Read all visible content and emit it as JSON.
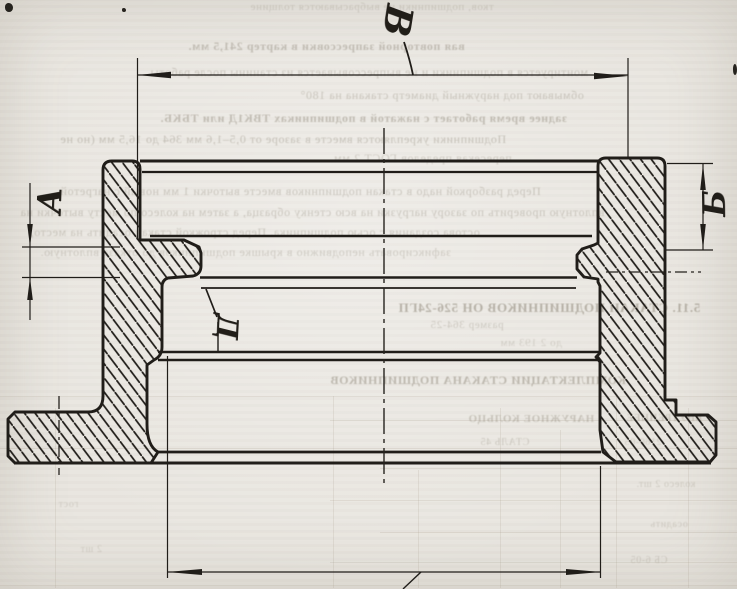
{
  "drawing": {
    "kind": "scanned engineering cross-section drawing",
    "ink_color": "#201d19",
    "paper_color": "#e9e6e0",
    "section_labels": {
      "top_dimension": "В",
      "left_dimension": "А",
      "right_dimension": "Б",
      "bore_callout": "Д"
    }
  },
  "bleedthrough": {
    "note": "mirrored show-through text from reverse page side",
    "color": "#837b6c",
    "heading1": "5.11. СТАКАН ПОДШИПНИКОВ ОН 526-24ГП",
    "heading2": "КОМПЛЕКТАЦИИ СТАКАНА ПОДШИПНИКОВ",
    "lines": [
      {
        "t": "тков, подшипники не выбрасываются толщине",
        "x": 250,
        "y": 2,
        "s": 11,
        "b": 0,
        "o": 0.26
      },
      {
        "t": "вая повторной запрессовки в картер 241,5 мм.",
        "x": 188,
        "y": 40,
        "s": 12,
        "b": 1,
        "o": 0.38
      },
      {
        "t": "монтируется в подшипники и не выпрессовывается из станины после работы",
        "x": 150,
        "y": 66,
        "s": 12,
        "b": 0,
        "o": 0.32
      },
      {
        "t": "обмывают под наружный диаметр стакана на 180°",
        "x": 300,
        "y": 89,
        "s": 12,
        "b": 0,
        "o": 0.33
      },
      {
        "t": "заднее время работает с нажатой в подшипниках ТВК1Д или ТБКБ.",
        "x": 160,
        "y": 112,
        "s": 12,
        "b": 1,
        "o": 0.4
      },
      {
        "t": "Подшипники укрепляются вместе в зазоре от 0,5–1,6 мм 364 до 16,5 мм (но не",
        "x": 60,
        "y": 133,
        "s": 12,
        "b": 0,
        "o": 0.36
      },
      {
        "t": "пересекая пределов ГОСТ 2 мм.",
        "x": 330,
        "y": 152,
        "s": 12,
        "b": 0,
        "o": 0.3
      },
      {
        "t": "Перед разборкой надо в стакан подшипников вместе выточки 1 мм новый с нагретой",
        "x": 60,
        "y": 185,
        "s": 12,
        "b": 0,
        "o": 0.33
      },
      {
        "t": "вплотную проверить по зазору нагрузки на всю стенку образца, а затем на колесо по месту выточки на",
        "x": 20,
        "y": 206,
        "s": 12,
        "b": 0,
        "o": 0.33
      },
      {
        "t": "остова создания с осью подшипника. Перед строжкой стакан осадить на место,",
        "x": 30,
        "y": 226,
        "s": 12,
        "b": 0,
        "o": 0.31
      },
      {
        "t": "зафиксировать неподвижно в крышке подшипников до отказа вплотную.",
        "x": 40,
        "y": 246,
        "s": 12,
        "b": 0,
        "o": 0.29
      },
      {
        "t": "5.11. СТАКАН ПОДШИПНИКОВ ОН 526-24ГП",
        "x": 398,
        "y": 301,
        "s": 13,
        "b": 1,
        "o": 0.5
      },
      {
        "t": "размер 364-25",
        "x": 430,
        "y": 320,
        "s": 11,
        "b": 0,
        "o": 0.3
      },
      {
        "t": "до 2 193 мм",
        "x": 500,
        "y": 338,
        "s": 11,
        "b": 0,
        "o": 0.25
      },
      {
        "t": "КОМПЛЕКТАЦИИ СТАКАНА ПОДШИПНИКОВ",
        "x": 330,
        "y": 374,
        "s": 12,
        "b": 1,
        "o": 0.44
      },
      {
        "t": "НАРУЖНОЕ КОЛЬЦО",
        "x": 468,
        "y": 414,
        "s": 11,
        "b": 1,
        "o": 0.34
      },
      {
        "t": "ВНУТРЕННЕЕ",
        "x": 626,
        "y": 414,
        "s": 10,
        "b": 1,
        "o": 0.3
      },
      {
        "t": "СТАЛЬ 45",
        "x": 480,
        "y": 438,
        "s": 10,
        "b": 0,
        "o": 0.3
      },
      {
        "t": "2160-05",
        "x": 624,
        "y": 438,
        "s": 10,
        "b": 0,
        "o": 0.27
      },
      {
        "t": "колесо 2 шт.",
        "x": 636,
        "y": 480,
        "s": 10,
        "b": 0,
        "o": 0.27
      },
      {
        "t": "осадить",
        "x": 650,
        "y": 520,
        "s": 10,
        "b": 0,
        "o": 0.25
      },
      {
        "t": "СБ 6-05",
        "x": 630,
        "y": 556,
        "s": 10,
        "b": 0,
        "o": 0.27
      },
      {
        "t": "гост",
        "x": 58,
        "y": 500,
        "s": 10,
        "b": 0,
        "o": 0.23
      },
      {
        "t": "2 шт",
        "x": 80,
        "y": 545,
        "s": 10,
        "b": 0,
        "o": 0.23
      }
    ],
    "table_grid": {
      "opacity": 0.16,
      "vlines": [
        [
          55,
          408,
          588
        ],
        [
          333,
          396,
          588
        ],
        [
          418,
          470,
          588
        ],
        [
          500,
          408,
          588
        ],
        [
          560,
          430,
          588
        ],
        [
          616,
          396,
          588
        ],
        [
          688,
          408,
          588
        ]
      ],
      "hlines": [
        [
          396,
          0,
          737
        ],
        [
          420,
          330,
          737
        ],
        [
          448,
          0,
          737
        ],
        [
          468,
          380,
          737
        ],
        [
          500,
          330,
          737
        ],
        [
          532,
          380,
          737
        ],
        [
          562,
          330,
          737
        ],
        [
          585,
          0,
          737
        ]
      ]
    }
  }
}
